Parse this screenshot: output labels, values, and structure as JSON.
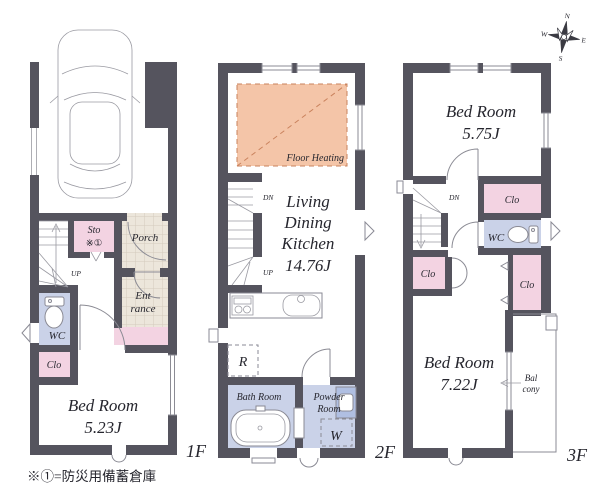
{
  "colors": {
    "wall": "#55545e",
    "closet_pink": "#f3d3e2",
    "sanitary_blue": "#cad2e8",
    "tile_beige": "#ece6db",
    "floor_heating": "#f4c5a8",
    "heating_line": "#c9825d"
  },
  "floor1": {
    "label": "1F",
    "up": "UP",
    "sto_line1": "Sto",
    "sto_line2": "※①",
    "porch": "Porch",
    "ent_line1": "Ent",
    "ent_line2": "rance",
    "wc": "WC",
    "clo": "Clo",
    "bed_name": "Bed Room",
    "bed_size": "5.23J"
  },
  "floor2": {
    "label": "2F",
    "floor_heating": "Floor Heating",
    "dn": "DN",
    "up": "UP",
    "ldk1": "Living",
    "ldk2": "Dining",
    "ldk3": "Kitchen",
    "ldk_size": "14.76J",
    "fridge": "R",
    "bath": "Bath Room",
    "powder1": "Powder",
    "powder2": "Room",
    "washer": "W"
  },
  "floor3": {
    "label": "3F",
    "dn": "DN",
    "bed1_name": "Bed Room",
    "bed1_size": "5.75J",
    "clo_top": "Clo",
    "wc": "WC",
    "clo_left": "Clo",
    "clo_right": "Clo",
    "bed2_name": "Bed Room",
    "bed2_size": "7.22J",
    "bal_line1": "Bal",
    "bal_line2": "cony"
  },
  "compass": {
    "n": "N",
    "e": "E",
    "s": "S",
    "w": "W"
  },
  "footnote": "※①=防災用備蓄倉庫"
}
